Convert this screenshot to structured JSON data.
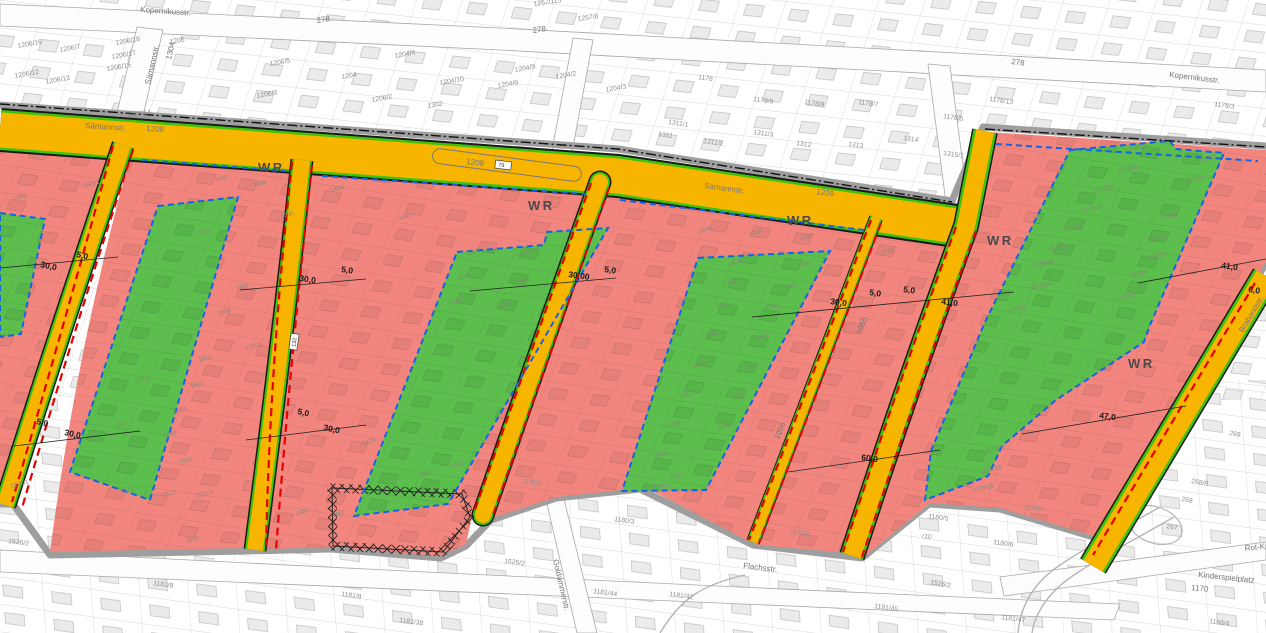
{
  "map": {
    "type": "zoning-cadastral-map",
    "colors": {
      "residential_red": "#F2867E",
      "green_area": "#5BBE4D",
      "road_yellow": "#F8B500",
      "strip_green": "#3DC30D",
      "dashed_red": "#E60000",
      "dashed_blue": "#1563E6",
      "casing_gray": "#9E9E9E",
      "label_gray": "#8F8F8F",
      "zone_label": "#8A8578",
      "street_label": "#757575",
      "dim_color": "#1A1A1A",
      "wr_color": "#4A4A4A"
    },
    "wr_labels": [
      {
        "t": "WR",
        "x": 258,
        "y": 172,
        "r": 0
      },
      {
        "t": "WR",
        "x": 528,
        "y": 210,
        "r": 0
      },
      {
        "t": "WR",
        "x": 787,
        "y": 225,
        "r": 0
      },
      {
        "t": "WR",
        "x": 987,
        "y": 245,
        "r": 0
      },
      {
        "t": "WR",
        "x": 1128,
        "y": 368,
        "r": 0
      }
    ],
    "street_labels": [
      {
        "t": "Kopernikusstr.",
        "x": 140,
        "y": 12,
        "r": 4
      },
      {
        "t": "Kopernikusstr.",
        "x": 1169,
        "y": 77,
        "r": 7
      },
      {
        "t": "Sämannstr.",
        "x": 85,
        "y": 128,
        "r": 4
      },
      {
        "t": "1208",
        "x": 146,
        "y": 131,
        "r": 4
      },
      {
        "t": "1208",
        "x": 466,
        "y": 164,
        "r": 7
      },
      {
        "t": "Sämannstr.",
        "x": 704,
        "y": 188,
        "r": 8
      },
      {
        "t": "1209",
        "x": 816,
        "y": 194,
        "r": 8
      },
      {
        "t": "Sämannstr.",
        "x": 150,
        "y": 85,
        "r": -77
      },
      {
        "t": "1304",
        "x": 171,
        "y": 60,
        "r": -77
      },
      {
        "t": "Flachsstr.",
        "x": 743,
        "y": 568,
        "r": 7
      },
      {
        "t": "Goldammerstr.",
        "x": 553,
        "y": 560,
        "r": 77
      },
      {
        "t": "Brabandstr.",
        "x": 1243,
        "y": 333,
        "r": -59
      },
      {
        "t": "Rot-Kreu",
        "x": 1245,
        "y": 551,
        "r": -6
      },
      {
        "t": "Kinderspielplatz",
        "x": 1198,
        "y": 577,
        "r": 6
      },
      {
        "t": "1170",
        "x": 1191,
        "y": 590,
        "r": 6
      },
      {
        "t": "1055",
        "x": 861,
        "y": 335,
        "r": -69
      },
      {
        "t": "1056",
        "x": 779,
        "y": 440,
        "r": -69
      },
      {
        "t": "278",
        "x": 317,
        "y": 23,
        "r": -8
      },
      {
        "t": "278",
        "x": 533,
        "y": 33,
        "r": -8
      },
      {
        "t": "278",
        "x": 1011,
        "y": 64,
        "r": 7
      }
    ],
    "dimension_labels": [
      {
        "t": "5,0",
        "x": 76,
        "y": 257,
        "r": 12
      },
      {
        "t": "30,0",
        "x": 40,
        "y": 267,
        "r": 12
      },
      {
        "t": "5,0",
        "x": 341,
        "y": 272,
        "r": 8
      },
      {
        "t": "30,0",
        "x": 299,
        "y": 281,
        "r": 8
      },
      {
        "t": "30,00",
        "x": 568,
        "y": 277,
        "r": 8
      },
      {
        "t": "5,0",
        "x": 604,
        "y": 272,
        "r": 8
      },
      {
        "t": "30,0",
        "x": 830,
        "y": 304,
        "r": 8
      },
      {
        "t": "5,0",
        "x": 869,
        "y": 295,
        "r": 8
      },
      {
        "t": "5,0",
        "x": 903,
        "y": 292,
        "r": 8
      },
      {
        "t": "41,0",
        "x": 941,
        "y": 304,
        "r": 8
      },
      {
        "t": "41,0",
        "x": 1221,
        "y": 268,
        "r": 8
      },
      {
        "t": "6,0",
        "x": 1248,
        "y": 292,
        "r": 8
      },
      {
        "t": "5,0",
        "x": 297,
        "y": 414,
        "r": 12
      },
      {
        "t": "30,0",
        "x": 323,
        "y": 430,
        "r": 12
      },
      {
        "t": "5,0",
        "x": 36,
        "y": 424,
        "r": 12
      },
      {
        "t": "30,0",
        "x": 64,
        "y": 435,
        "r": 12
      },
      {
        "t": "60,0",
        "x": 861,
        "y": 460,
        "r": 8
      },
      {
        "t": "47,0",
        "x": 1099,
        "y": 418,
        "r": 8
      }
    ],
    "parcel_labels_background": [
      {
        "t": "1206/16",
        "x": 18,
        "y": 48,
        "r": -10
      },
      {
        "t": "1206/7",
        "x": 60,
        "y": 52,
        "r": -10
      },
      {
        "t": "1206/18",
        "x": 116,
        "y": 45,
        "r": -10
      },
      {
        "t": "1206",
        "x": 170,
        "y": 44,
        "r": -10
      },
      {
        "t": "1206/17",
        "x": 112,
        "y": 59,
        "r": -10
      },
      {
        "t": "1206/15",
        "x": 107,
        "y": 71,
        "r": -10
      },
      {
        "t": "1206/12",
        "x": 15,
        "y": 78,
        "r": -10
      },
      {
        "t": "1206/13",
        "x": 46,
        "y": 84,
        "r": -10
      },
      {
        "t": "1206/14",
        "x": 127,
        "y": 118,
        "r": -10
      },
      {
        "t": "1206/5",
        "x": 270,
        "y": 66,
        "r": -10
      },
      {
        "t": "1206/3",
        "x": 257,
        "y": 98,
        "r": -10
      },
      {
        "t": "1206/2",
        "x": 372,
        "y": 102,
        "r": -10
      },
      {
        "t": "1204/4",
        "x": 395,
        "y": 58,
        "r": -10
      },
      {
        "t": "1204",
        "x": 342,
        "y": 79,
        "r": -10
      },
      {
        "t": "1204/10",
        "x": 440,
        "y": 85,
        "r": -10
      },
      {
        "t": "1204/9",
        "x": 515,
        "y": 72,
        "r": -10
      },
      {
        "t": "1204/9",
        "x": 498,
        "y": 88,
        "r": -10
      },
      {
        "t": "1204/2",
        "x": 556,
        "y": 79,
        "r": -10
      },
      {
        "t": "1204/3",
        "x": 606,
        "y": 92,
        "r": -10
      },
      {
        "t": "1302",
        "x": 428,
        "y": 108,
        "r": -10
      },
      {
        "t": "1257/115",
        "x": 534,
        "y": 6,
        "r": -8
      },
      {
        "t": "1257/6",
        "x": 578,
        "y": 21,
        "r": -8
      },
      {
        "t": "1178",
        "x": 698,
        "y": 79,
        "r": 8
      },
      {
        "t": "1178/9",
        "x": 753,
        "y": 101,
        "r": 8
      },
      {
        "t": "1178/8",
        "x": 804,
        "y": 104,
        "r": 8
      },
      {
        "t": "1178/7",
        "x": 858,
        "y": 104,
        "r": 8
      },
      {
        "t": "1178/5",
        "x": 943,
        "y": 118,
        "r": 8
      },
      {
        "t": "1311/1",
        "x": 668,
        "y": 124,
        "r": 8
      },
      {
        "t": "1311",
        "x": 658,
        "y": 136,
        "r": 8
      },
      {
        "t": "1311/2",
        "x": 703,
        "y": 143,
        "r": 8
      },
      {
        "t": "1311/3",
        "x": 753,
        "y": 134,
        "r": 8
      },
      {
        "t": "1312",
        "x": 796,
        "y": 145,
        "r": 8
      },
      {
        "t": "1313",
        "x": 848,
        "y": 146,
        "r": 8
      },
      {
        "t": "1314",
        "x": 903,
        "y": 140,
        "r": 8
      },
      {
        "t": "1315/1",
        "x": 943,
        "y": 155,
        "r": 8
      },
      {
        "t": "1178/13",
        "x": 989,
        "y": 101,
        "r": 8
      },
      {
        "t": "1178/3",
        "x": 1214,
        "y": 106,
        "r": 8
      },
      {
        "t": "1180/2",
        "x": 522,
        "y": 483,
        "r": 8
      },
      {
        "t": "1180/7",
        "x": 652,
        "y": 487,
        "r": 8
      },
      {
        "t": "1180/3",
        "x": 614,
        "y": 521,
        "r": 8
      },
      {
        "t": "1180/4",
        "x": 789,
        "y": 533,
        "r": 8
      },
      {
        "t": "1180/5",
        "x": 928,
        "y": 518,
        "r": 8
      },
      {
        "t": "/10",
        "x": 922,
        "y": 538,
        "r": 8
      },
      {
        "t": "1180/6",
        "x": 993,
        "y": 544,
        "r": 8
      },
      {
        "t": "1180/9",
        "x": 1024,
        "y": 509,
        "r": 8
      },
      {
        "t": "1526/2",
        "x": 8,
        "y": 543,
        "r": 7
      },
      {
        "t": "1526/2",
        "x": 504,
        "y": 563,
        "r": 7
      },
      {
        "t": "1526/2",
        "x": 930,
        "y": 584,
        "r": 10
      },
      {
        "t": "1181/8",
        "x": 153,
        "y": 585,
        "r": 8
      },
      {
        "t": "1181/8",
        "x": 341,
        "y": 596,
        "r": 8
      },
      {
        "t": "1181/38",
        "x": 399,
        "y": 622,
        "r": 8
      },
      {
        "t": "1181/44",
        "x": 593,
        "y": 593,
        "r": 8
      },
      {
        "t": "1181/42",
        "x": 669,
        "y": 596,
        "r": 8
      },
      {
        "t": "1181/45",
        "x": 874,
        "y": 608,
        "r": 8
      },
      {
        "t": "1181/47",
        "x": 1001,
        "y": 619,
        "r": 8
      },
      {
        "t": "268/8",
        "x": 1191,
        "y": 483,
        "r": 10
      },
      {
        "t": "268",
        "x": 1181,
        "y": 501,
        "r": 10
      },
      {
        "t": "267",
        "x": 1166,
        "y": 528,
        "r": 10
      },
      {
        "t": "269",
        "x": 1229,
        "y": 435,
        "r": 10
      },
      {
        "t": "1168/4",
        "x": 1209,
        "y": 623,
        "r": 8
      }
    ],
    "parcel_labels_zones": [
      {
        "t": "1942",
        "x": 14,
        "y": 200,
        "r": -14
      },
      {
        "t": "1943/1",
        "x": 82,
        "y": 188,
        "r": -14
      },
      {
        "t": "1494",
        "x": 331,
        "y": 192,
        "r": -14
      },
      {
        "t": "1463",
        "x": 399,
        "y": 220,
        "r": -14
      },
      {
        "t": "1319",
        "x": 699,
        "y": 233,
        "r": -14
      },
      {
        "t": "1318",
        "x": 749,
        "y": 236,
        "r": -14
      },
      {
        "t": "1317",
        "x": 801,
        "y": 240,
        "r": -14
      },
      {
        "t": "1316",
        "x": 881,
        "y": 255,
        "r": -14
      },
      {
        "t": "1510/1",
        "x": 246,
        "y": 350,
        "r": -14
      },
      {
        "t": "1520",
        "x": 179,
        "y": 464,
        "r": -14
      },
      {
        "t": "1522",
        "x": 163,
        "y": 497,
        "r": -14
      },
      {
        "t": "1521/1",
        "x": 196,
        "y": 498,
        "r": -14
      },
      {
        "t": "1524",
        "x": 186,
        "y": 543,
        "r": -14
      },
      {
        "t": "1525/1",
        "x": 11,
        "y": 488,
        "r": -14
      },
      {
        "t": "1483",
        "x": 296,
        "y": 515,
        "r": -14
      },
      {
        "t": "1482",
        "x": 332,
        "y": 517,
        "r": -14
      },
      {
        "t": "1478",
        "x": 363,
        "y": 445,
        "r": -14
      },
      {
        "t": "1480",
        "x": 451,
        "y": 468,
        "r": -14
      },
      {
        "t": "1481",
        "x": 421,
        "y": 477,
        "r": -14
      },
      {
        "t": "1497",
        "x": 216,
        "y": 182,
        "r": -14
      },
      {
        "t": "1498",
        "x": 254,
        "y": 187,
        "r": -14
      },
      {
        "t": "1500",
        "x": 281,
        "y": 218,
        "r": -14
      },
      {
        "t": "1501",
        "x": 198,
        "y": 235,
        "r": -14
      },
      {
        "t": "1508",
        "x": 236,
        "y": 290,
        "r": -14
      },
      {
        "t": "1509",
        "x": 218,
        "y": 315,
        "r": -14
      },
      {
        "t": "1512",
        "x": 199,
        "y": 362,
        "r": -14
      },
      {
        "t": "1514",
        "x": 191,
        "y": 388,
        "r": -14
      },
      {
        "t": "1515",
        "x": 136,
        "y": 383,
        "r": -14
      },
      {
        "t": "1516",
        "x": 174,
        "y": 413,
        "r": -14
      },
      {
        "t": "1517",
        "x": 116,
        "y": 428,
        "r": -14
      },
      {
        "t": "1518",
        "x": 164,
        "y": 437,
        "r": -14
      },
      {
        "t": "1523",
        "x": 121,
        "y": 493,
        "r": -14
      },
      {
        "t": "1473",
        "x": 468,
        "y": 255,
        "r": -14
      },
      {
        "t": "1470",
        "x": 518,
        "y": 258,
        "r": -14
      },
      {
        "t": "1475",
        "x": 458,
        "y": 280,
        "r": -14
      },
      {
        "t": "1469",
        "x": 516,
        "y": 284,
        "r": -14
      },
      {
        "t": "1477",
        "x": 451,
        "y": 305,
        "r": -14
      },
      {
        "t": "1468",
        "x": 499,
        "y": 308,
        "r": -14
      },
      {
        "t": "1443",
        "x": 729,
        "y": 266,
        "r": -14
      },
      {
        "t": "1442",
        "x": 799,
        "y": 267,
        "r": -14
      },
      {
        "t": "1444",
        "x": 724,
        "y": 286,
        "r": -14
      },
      {
        "t": "1445",
        "x": 784,
        "y": 290,
        "r": -14
      },
      {
        "t": "1447",
        "x": 716,
        "y": 308,
        "r": -14
      },
      {
        "t": "1446",
        "x": 766,
        "y": 310,
        "r": -14
      },
      {
        "t": "1448",
        "x": 705,
        "y": 338,
        "r": -14
      },
      {
        "t": "1449",
        "x": 757,
        "y": 340,
        "r": -14
      },
      {
        "t": "1450",
        "x": 693,
        "y": 368,
        "r": -14
      },
      {
        "t": "1451",
        "x": 745,
        "y": 370,
        "r": -14
      },
      {
        "t": "1452",
        "x": 680,
        "y": 398,
        "r": -14
      },
      {
        "t": "1453",
        "x": 732,
        "y": 400,
        "r": -14
      },
      {
        "t": "1455",
        "x": 668,
        "y": 428,
        "r": -14
      },
      {
        "t": "1456",
        "x": 718,
        "y": 430,
        "r": -14
      },
      {
        "t": "1458",
        "x": 655,
        "y": 458,
        "r": -14
      },
      {
        "t": "1460",
        "x": 670,
        "y": 480,
        "r": -14
      },
      {
        "t": "1179/23",
        "x": 1126,
        "y": 152,
        "r": -12
      },
      {
        "t": "1179/2",
        "x": 1199,
        "y": 162,
        "r": -12
      },
      {
        "t": "1179/41",
        "x": 1118,
        "y": 173,
        "r": -12
      },
      {
        "t": "1179/3",
        "x": 1186,
        "y": 183,
        "r": -12
      },
      {
        "t": "1179/25",
        "x": 1094,
        "y": 193,
        "r": -12
      },
      {
        "t": "1179/26",
        "x": 1082,
        "y": 212,
        "r": -12
      },
      {
        "t": "1179/5",
        "x": 1161,
        "y": 220,
        "r": -12
      },
      {
        "t": "1179/27",
        "x": 1064,
        "y": 232,
        "r": -12
      },
      {
        "t": "1179/6",
        "x": 1148,
        "y": 242,
        "r": -12
      },
      {
        "t": "1179/28",
        "x": 1050,
        "y": 252,
        "r": -12
      },
      {
        "t": "1179/7",
        "x": 1149,
        "y": 260,
        "r": -12
      },
      {
        "t": "1179/29",
        "x": 1033,
        "y": 268,
        "r": -12
      },
      {
        "t": "1179/8",
        "x": 1131,
        "y": 277,
        "r": -12
      },
      {
        "t": "1179/44",
        "x": 1031,
        "y": 290,
        "r": -12
      },
      {
        "t": "1179/9",
        "x": 1119,
        "y": 300,
        "r": -12
      },
      {
        "t": "1179/31",
        "x": 1006,
        "y": 313,
        "r": -12
      },
      {
        "t": "1179/17",
        "x": 986,
        "y": 453,
        "r": -12
      },
      {
        "t": "1179/16",
        "x": 981,
        "y": 473,
        "r": -12
      },
      {
        "t": "1179/18",
        "x": 973,
        "y": 492,
        "r": -12
      }
    ],
    "marker_boxes": [
      {
        "t": "79",
        "x": 503,
        "y": 167,
        "r": 7
      },
      {
        "t": "132",
        "x": 296,
        "y": 342,
        "r": -82
      }
    ]
  }
}
